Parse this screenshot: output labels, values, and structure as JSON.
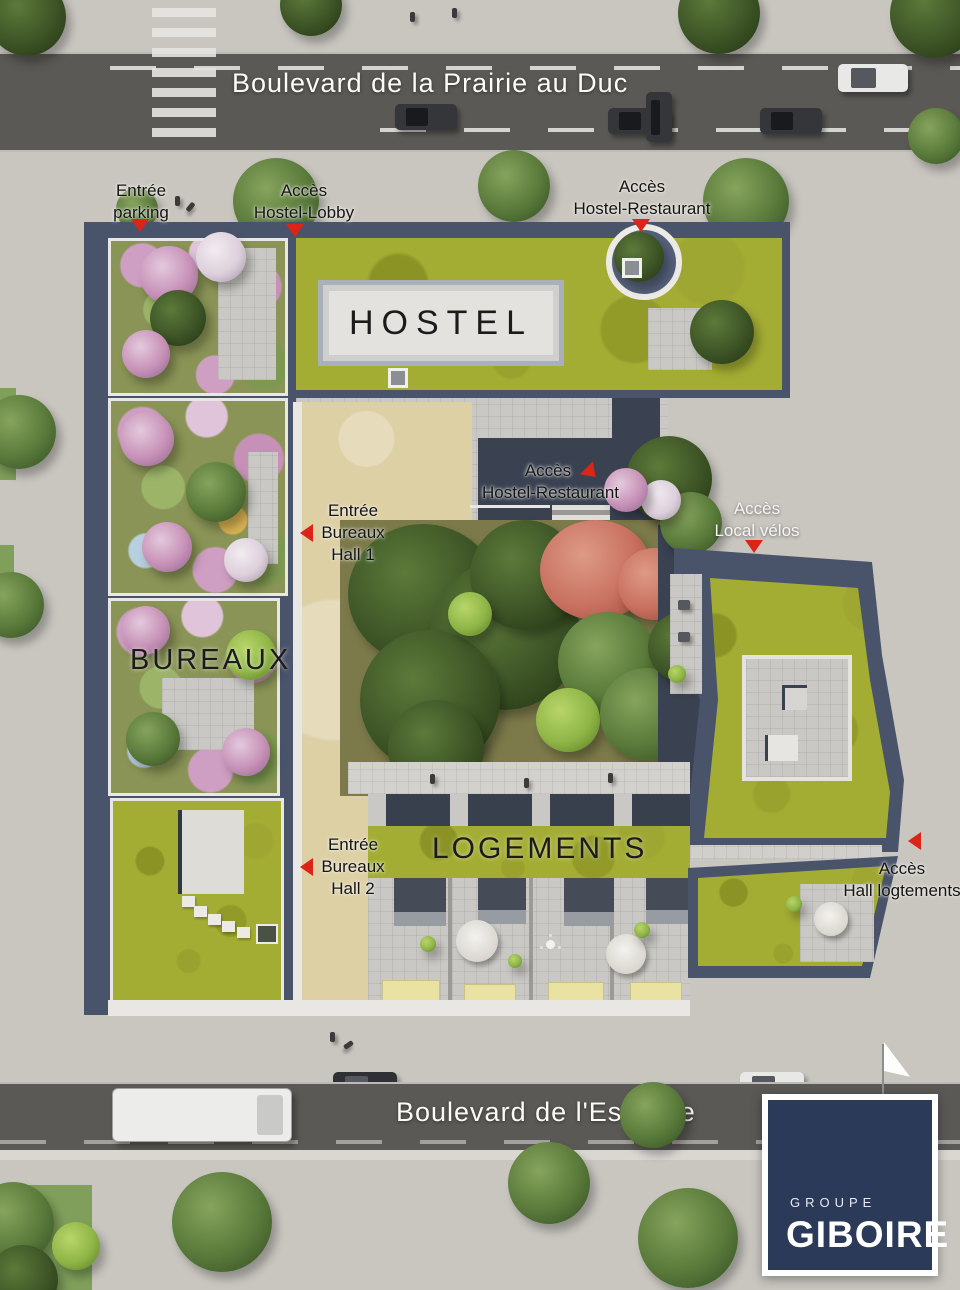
{
  "streets": {
    "top_label": "Boulevard de la Prairie au Duc",
    "bottom_label": "Boulevard de l'Estuaire"
  },
  "buildings": {
    "hostel_label": "HOSTEL",
    "bureaux_label": "BUREAUX",
    "logements_label": "LOGEMENTS"
  },
  "annotations": {
    "entree_parking": {
      "line1": "Entrée",
      "line2": "parking"
    },
    "acces_hostel_lobby": {
      "line1": "Accès",
      "line2": "Hostel-Lobby"
    },
    "acces_hostel_restaurant_top": {
      "line1": "Accès",
      "line2": "Hostel-Restaurant"
    },
    "acces_hostel_restaurant_mid": {
      "line1": "Accès",
      "line2": "Hostel-Restaurant"
    },
    "entree_bureaux_hall_1": {
      "line1": "Entrée",
      "line2": "Bureaux",
      "line3": "Hall 1"
    },
    "acces_local_velos": {
      "line1": "Accès",
      "line2": "Local vélos"
    },
    "entree_bureaux_hall_2": {
      "line1": "Entrée",
      "line2": "Bureaux",
      "line3": "Hall 2"
    },
    "acces_hall_logements": {
      "line1": "Accès",
      "line2": "Hall logtements"
    }
  },
  "logo": {
    "group_label": "GROUPE",
    "brand_label": "GIBOIRE"
  },
  "colors": {
    "arrow_red": "#dc2418",
    "roof_slate": "#49536a",
    "roof_green": "#a4ad33",
    "garden_green": "#8a9456",
    "sand": "#ddd0a4",
    "asphalt": "#5b5955",
    "sidewalk": "#c9c6c0",
    "awning_yellow": "#e9e2a2",
    "logo_navy": "#2b3a59"
  }
}
